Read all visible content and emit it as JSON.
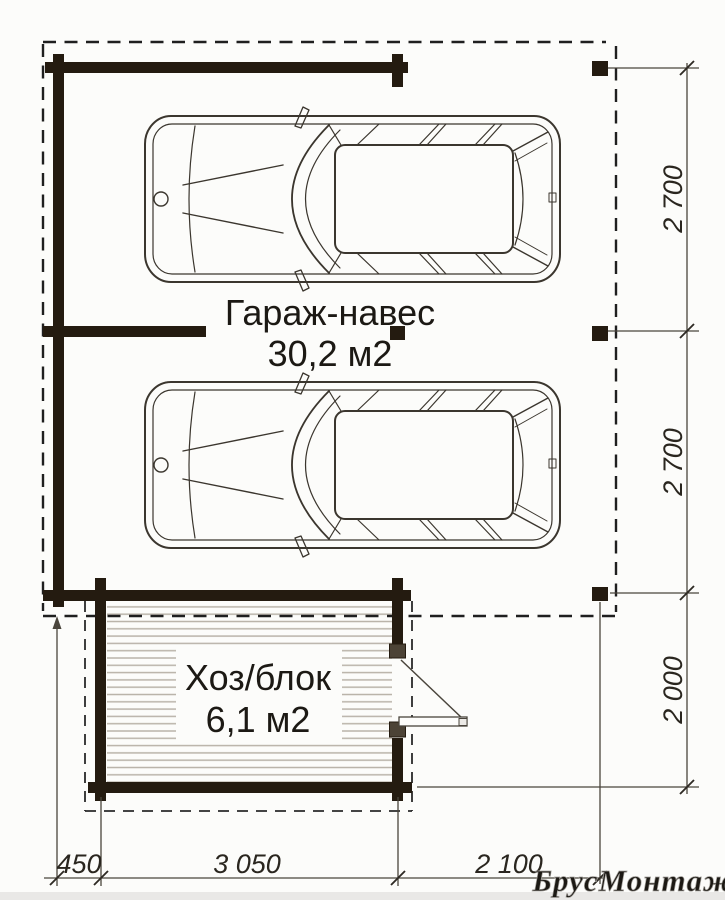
{
  "labels": {
    "garage": {
      "name": "Гараж-навес",
      "area": "30,2 м2"
    },
    "utility": {
      "name": "Хоз/блок",
      "area": "6,1 м2"
    }
  },
  "dimensions": {
    "right": [
      {
        "value": "2 700"
      },
      {
        "value": "2 700"
      },
      {
        "value": "2 000"
      }
    ],
    "bottom": [
      {
        "value": "450"
      },
      {
        "value": "3 050"
      },
      {
        "value": "2 100"
      }
    ]
  },
  "watermark": "БрусМонтаж",
  "colors": {
    "wall": "#241b10",
    "drawing_line": "#3b362e",
    "dash_line": "#1f1f1f",
    "dimension_line": "#4a453c",
    "hatch": "#b9b3a9",
    "watermark_fill": "#c8c5c0",
    "watermark_edge": "#a5a29d",
    "background": "#fcfcfa"
  }
}
